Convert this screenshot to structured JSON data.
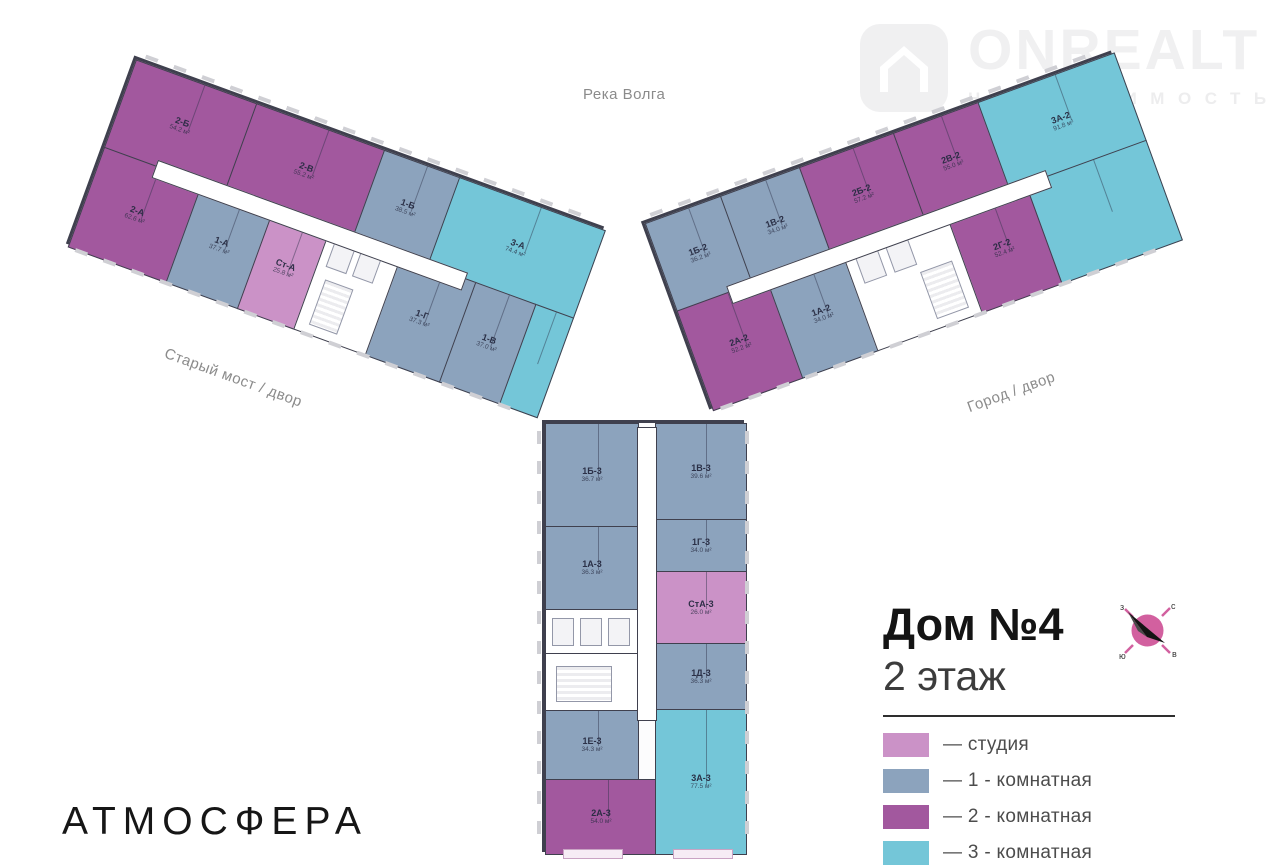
{
  "watermark": {
    "brand": "ONREALT",
    "subtitle": "НЕДВИЖИМОСТЬ"
  },
  "orientation": {
    "top": "Река Волга",
    "left": "Старый мост / двор",
    "right": "Город / двор"
  },
  "panel": {
    "title": "Дом №4",
    "floor": "2 этаж"
  },
  "legend": {
    "items": [
      {
        "label": "— студия",
        "color": "#cb92c7",
        "type": "studio"
      },
      {
        "label": "— 1 - комнатная",
        "color": "#8ca3bd",
        "type": "1-room"
      },
      {
        "label": "— 2 - комнатная",
        "color": "#a2589e",
        "type": "2-room"
      },
      {
        "label": "— 3 - комнатная",
        "color": "#74c6d8",
        "type": "3-room"
      }
    ]
  },
  "compass": {
    "north": "с",
    "east": "в",
    "south": "ю",
    "west": "з"
  },
  "brand_logo": "АТМОСФЕРА",
  "colors": {
    "wall": "#3f404e",
    "compass_rose": "#d2609f"
  },
  "wings": {
    "left": {
      "apartments": [
        {
          "id": "2-Б",
          "area": "54.2 м²"
        },
        {
          "id": "2-В",
          "area": "55.2 м²"
        },
        {
          "id": "1-Б",
          "area": "38.5 м²"
        },
        {
          "id": "3-А",
          "area": "74.4 м²"
        },
        {
          "id": "2-А",
          "area": "62.6 м²"
        },
        {
          "id": "1-А",
          "area": "37.7 м²"
        },
        {
          "id": "Ст-А",
          "area": "25.8 м²"
        },
        {
          "id": "1-Г",
          "area": "37.3 м²"
        },
        {
          "id": "1-В",
          "area": "37.0 м²"
        }
      ]
    },
    "right": {
      "apartments": [
        {
          "id": "1Б-2",
          "area": "36.2 м²"
        },
        {
          "id": "1В-2",
          "area": "34.0 м²"
        },
        {
          "id": "2Б-2",
          "area": "57.2 м²"
        },
        {
          "id": "2В-2",
          "area": "55.0 м²"
        },
        {
          "id": "3А-2",
          "area": "91.8 м²"
        },
        {
          "id": "2А-2",
          "area": "52.2 м²"
        },
        {
          "id": "1А-2",
          "area": "34.0 м²"
        },
        {
          "id": "2Г-2",
          "area": "52.4 м²"
        }
      ]
    },
    "bottom": {
      "apartments": [
        {
          "id": "1Б-3",
          "area": "36.7 м²"
        },
        {
          "id": "1В-3",
          "area": "39.6 м²"
        },
        {
          "id": "1А-3",
          "area": "36.3 м²"
        },
        {
          "id": "1Г-3",
          "area": "34.0 м²"
        },
        {
          "id": "СтА-3",
          "area": "26.0 м²"
        },
        {
          "id": "1Д-3",
          "area": "36.3 м²"
        },
        {
          "id": "1Е-3",
          "area": "34.3 м²"
        },
        {
          "id": "2А-3",
          "area": "54.0 м²"
        },
        {
          "id": "3А-3",
          "area": "77.5 м²"
        }
      ]
    }
  }
}
